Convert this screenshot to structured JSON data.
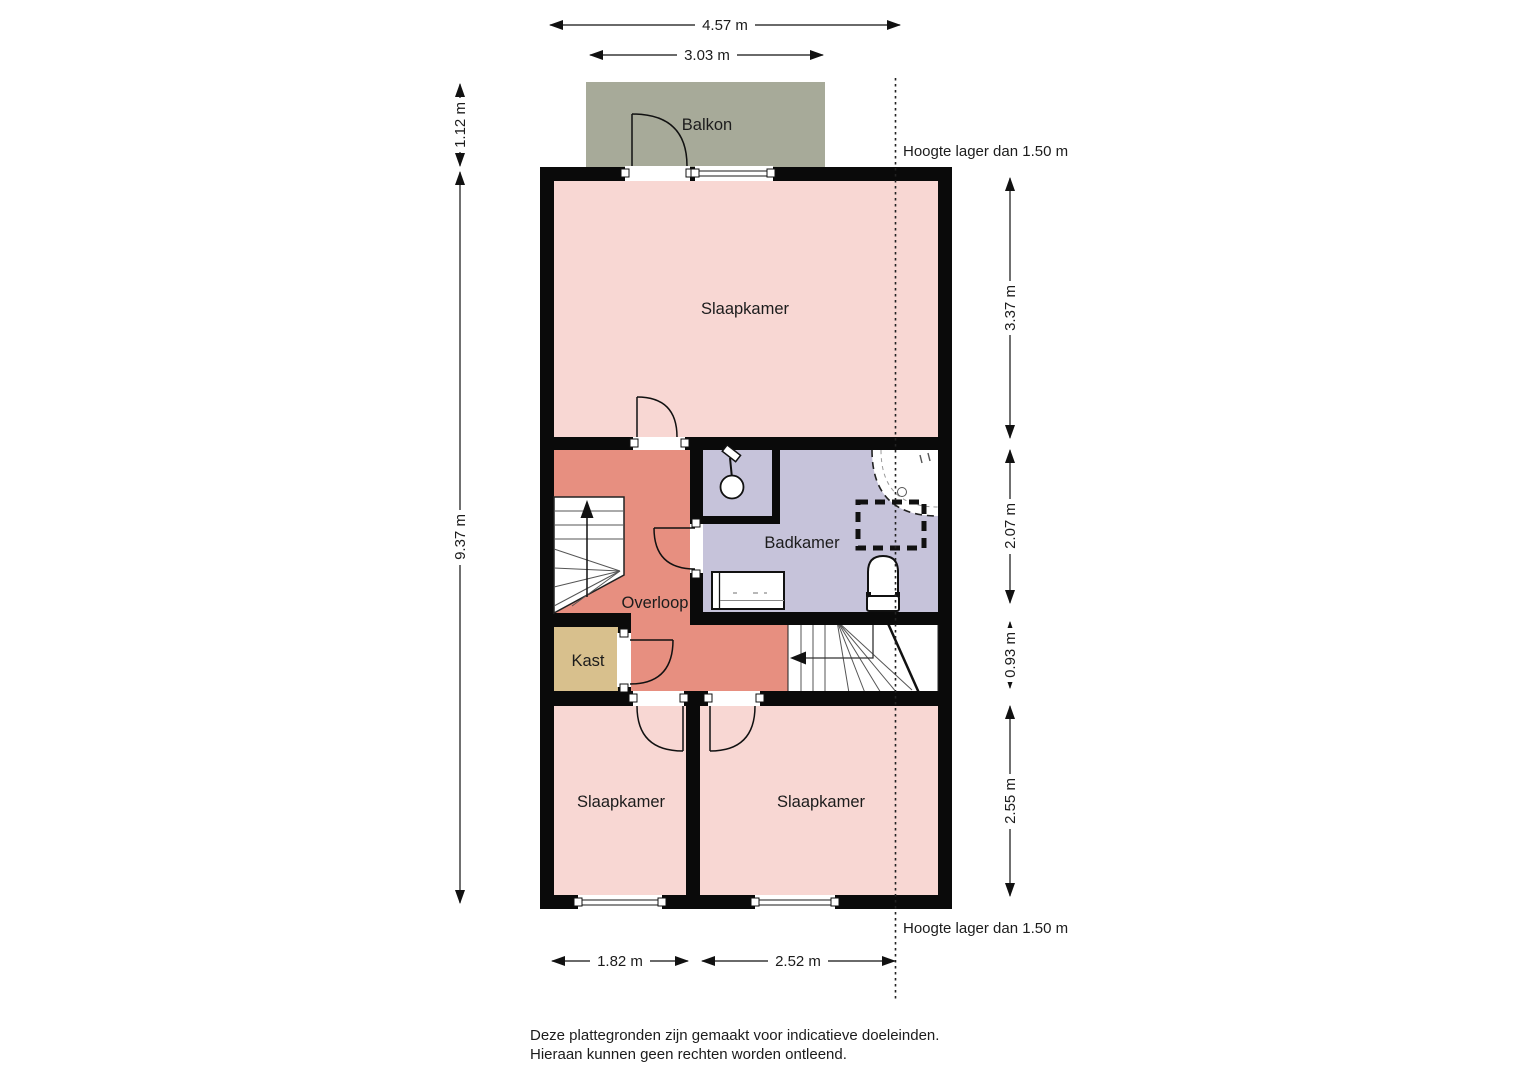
{
  "floorplan": {
    "balcony_label": "Balkon",
    "rooms": {
      "slaapkamer_top": "Slaapkamer",
      "badkamer": "Badkamer",
      "overloop": "Overloop",
      "kast": "Kast",
      "slaapkamer_links": "Slaapkamer",
      "slaapkamer_rechts": "Slaapkamer"
    },
    "dimensions": {
      "top_total": "4.57 m",
      "top_balcony": "3.03 m",
      "left_balcony": "1.12 m",
      "left_total": "9.37 m",
      "right_top": "3.37 m",
      "right_middle": "2.07 m",
      "right_stairs": "0.93 m",
      "right_bottom": "2.55 m",
      "bottom_left": "1.82 m",
      "bottom_right": "2.52 m"
    },
    "annotations": {
      "height_note_top": "Hoogte lager dan 1.50 m",
      "height_note_bottom": "Hoogte lager dan 1.50 m"
    },
    "colors": {
      "bedroom": "#f8d7d3",
      "hallway": "#e78f80",
      "bathroom": "#c6c3da",
      "closet": "#d8c08d",
      "balcony": "#a7aa99",
      "wall": "#0a0a0a"
    }
  },
  "footer": {
    "line1": "Deze plattegronden zijn gemaakt voor indicatieve doeleinden.",
    "line2": "Hieraan kunnen geen rechten worden ontleend."
  }
}
